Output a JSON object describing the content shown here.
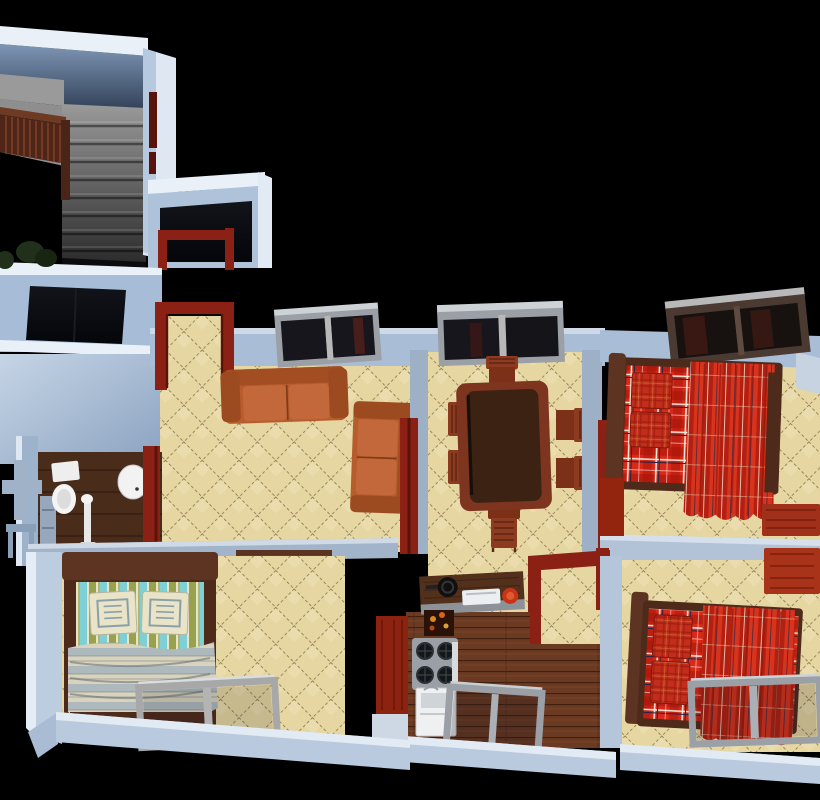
{
  "scene": {
    "kind": "3d-floorplan-cutaway-render",
    "background": "#000000"
  },
  "palette": {
    "background": "#000000",
    "wall": "#aec2da",
    "wall_band": "#a9bdd6",
    "wall_top_light": "#e9f0f8",
    "wall_face_light": "#c6d5e6",
    "wall_face_dark": "#8aa2c0",
    "wall_shadow": "#9db0c6",
    "stair_concrete": "#9a9a9a",
    "stair_dark": "#2b2b2b",
    "railing_wood": "#4e2517",
    "railing_slat": "#7c4028",
    "door_frame": "#8a2114",
    "door_frame_dark": "#58130b",
    "tile_base": "#e6d6a2",
    "tile_line": "#7c6b42",
    "wood_floor": "#6a3a22",
    "wood_line": "#401f0f",
    "bath_floor": "#4a2c1b",
    "sofa": "#b75c2c",
    "sofa_dark": "#9c4a20",
    "sofa_cushion": "#c3683a",
    "table_frame": "#7e3520",
    "table_top": "#3c2212",
    "chair_wood": "#8c3a20",
    "bed_frame": "#4e2a1b",
    "plaid_base": "#d92a19",
    "plaid_dark": "#a31408",
    "plaid_white": "#f2e9d8",
    "plaid_navy": "#232347",
    "pillow_red": "#c22e1c",
    "drape_dark": "#b31f10",
    "drape_light": "#d7331d",
    "green_olive": "#97a14e",
    "green_cyan": "#7fd0d6",
    "cream": "#e9e3c8",
    "blanket_gray": "#aeb9bd",
    "blanket_cream": "#d9d3bd",
    "window_frame": "#9aa0a6",
    "window_frame_light": "#cdd2d6",
    "window_wood_frame": "#4a3a32",
    "glass": "#16161c",
    "fixture_white": "#f2f2f2",
    "stool_orange": "#e8860f",
    "cabinet_red": "#8c2310",
    "dresser_red": "#a0301a",
    "plant_green": "#20301a",
    "stove_gray": "#9aa0a6",
    "appliance_white": "#eef0f2"
  },
  "rooms": [
    {
      "id": "staircase",
      "label": "staircase"
    },
    {
      "id": "entry-room",
      "label": "entry room"
    },
    {
      "id": "dark-room",
      "label": "dark side room"
    },
    {
      "id": "bathroom",
      "label": "bathroom"
    },
    {
      "id": "living-room",
      "label": "living room"
    },
    {
      "id": "dining-room",
      "label": "dining room"
    },
    {
      "id": "kitchen",
      "label": "kitchen"
    },
    {
      "id": "bedroom-top-right",
      "label": "bedroom with plaid bed (top right)"
    },
    {
      "id": "bedroom-bottom-right",
      "label": "bedroom with plaid bed (bottom right)"
    },
    {
      "id": "bedroom-bottom-left",
      "label": "bedroom with striped bed (bottom left)"
    }
  ],
  "furniture": [
    "concrete-stairs",
    "stair-railing",
    "plant",
    "toilet",
    "wash-basin",
    "shower-stand",
    "sofa-horizontal",
    "sofa-vertical",
    "living-window",
    "dining-table",
    "dining-chairs",
    "dining-window",
    "plaid-bed-top",
    "plaid-bed-bottom",
    "striped-bed",
    "bedside-dressers",
    "wardrobe",
    "kitchen-counter",
    "frying-pan",
    "sink-tray",
    "gas-stove",
    "dishwasher",
    "desk",
    "orange-stool",
    "leaning-window-left",
    "leaning-window-right",
    "kitchen-window",
    "door-frames-maroon"
  ]
}
